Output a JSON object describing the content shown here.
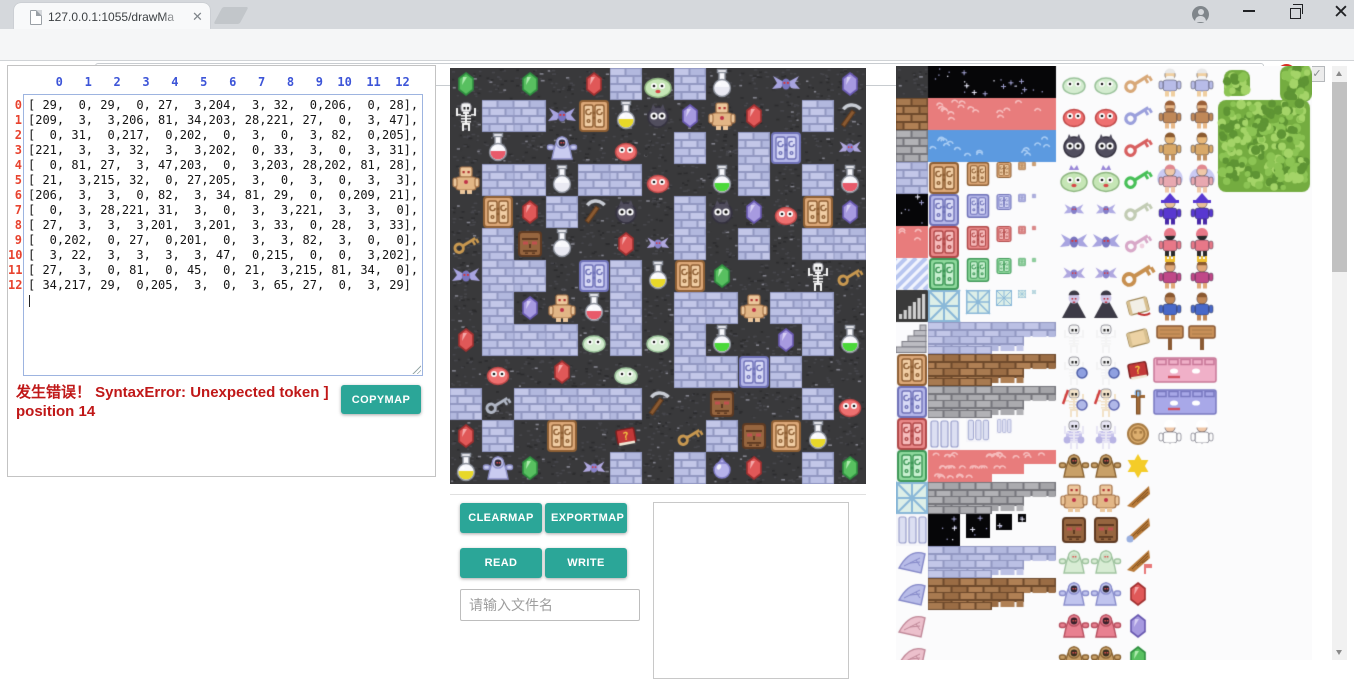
{
  "browser": {
    "tab_title": "127.0.0.1:1055/drawMa",
    "url_host": "127.0.0.1:1055",
    "url_path": "/drawMapGUI.html"
  },
  "editor": {
    "column_headers": [
      0,
      1,
      2,
      3,
      4,
      5,
      6,
      7,
      8,
      9,
      10,
      11,
      12
    ],
    "row_labels": [
      0,
      1,
      2,
      3,
      4,
      5,
      6,
      7,
      8,
      9,
      10,
      11,
      12
    ],
    "matrix": [
      [
        29,
        0,
        29,
        0,
        27,
        3,
        204,
        3,
        32,
        0,
        206,
        0,
        28
      ],
      [
        209,
        3,
        3,
        206,
        81,
        34,
        203,
        28,
        221,
        27,
        0,
        3,
        47
      ],
      [
        0,
        31,
        0,
        217,
        0,
        202,
        0,
        3,
        0,
        3,
        82,
        0,
        205
      ],
      [
        221,
        3,
        3,
        32,
        3,
        3,
        202,
        0,
        33,
        3,
        0,
        3,
        31
      ],
      [
        0,
        81,
        27,
        3,
        47,
        203,
        0,
        3,
        203,
        28,
        202,
        81,
        28
      ],
      [
        21,
        3,
        215,
        32,
        0,
        27,
        205,
        3,
        0,
        3,
        0,
        3,
        3
      ],
      [
        206,
        3,
        3,
        0,
        82,
        3,
        34,
        81,
        29,
        0,
        0,
        209,
        21
      ],
      [
        0,
        3,
        28,
        221,
        31,
        3,
        0,
        3,
        3,
        221,
        3,
        3,
        0
      ],
      [
        27,
        3,
        3,
        3,
        201,
        3,
        201,
        3,
        33,
        0,
        28,
        3,
        33
      ],
      [
        0,
        202,
        0,
        27,
        0,
        201,
        0,
        3,
        3,
        82,
        3,
        0,
        0
      ],
      [
        3,
        22,
        3,
        3,
        3,
        3,
        47,
        0,
        215,
        0,
        0,
        3,
        202
      ],
      [
        27,
        3,
        0,
        81,
        0,
        45,
        0,
        21,
        3,
        215,
        81,
        34,
        0
      ],
      [
        34,
        217,
        29,
        0,
        205,
        3,
        0,
        3,
        65,
        27,
        0,
        3,
        29
      ]
    ],
    "error_text": "发生错误！ SyntaxError: Unexpected token ] position 14",
    "copymap_label": "COPYMAP"
  },
  "controls": {
    "clearmap_label": "CLEARMAP",
    "exportmap_label": "EXPORTMAP",
    "read_label": "READ",
    "write_label": "WRITE",
    "filename_placeholder": "请输入文件名"
  },
  "map_legend": {
    "0": "floor-dark",
    "3": "wall-brick",
    "21": "key-gold",
    "22": "key-silver",
    "27": "gem-red",
    "28": "gem-purple",
    "29": "gem-green",
    "31": "flask-red",
    "32": "flask-white",
    "33": "flask-green",
    "34": "flask-yellow",
    "45": "book-red",
    "47": "pickaxe",
    "65": "orb-purple",
    "81": "gate-brown",
    "82": "gate-purple",
    "201": "slime-pale",
    "202": "slime-red",
    "203": "slime-dark",
    "204": "slime-green",
    "205": "bat-red",
    "206": "bat-purple",
    "209": "skeleton",
    "215": "stone-face",
    "217": "ghost-hooded",
    "221": "golem"
  },
  "tileset": {
    "left_column": [
      "dark-cobble",
      "brown-brick",
      "grey-stone",
      "blue-cobble",
      "starry",
      "red-terrain",
      "diag-stripes",
      "grad-bars",
      "stairs",
      "gate-brown",
      "gate-blue",
      "gate-red",
      "gate-green",
      "lattice",
      "pillar",
      "wing-blue",
      "wing-blue",
      "wing-pink",
      "wing-pink"
    ],
    "wide_strips": [
      "starry",
      "red-terrain",
      "blue-water"
    ],
    "gate_mip_rows": [
      "gate-brown",
      "gate-blue",
      "gate-red",
      "gate-green",
      "lattice"
    ],
    "step_rows": [
      "blue-cobble",
      "brown-brick",
      "grey-stone",
      "pillar",
      "red-terrain",
      "grey-stone",
      "starry",
      "blue-cobble",
      "brown-brick"
    ],
    "sprite_rows": [
      {
        "monster": "slime-pale",
        "item": "key-brown",
        "character": "elder"
      },
      {
        "monster": "slime-red",
        "item": "key-blue",
        "character": "dwarf"
      },
      {
        "monster": "slime-dark",
        "item": "key-red",
        "character": "fighter"
      },
      {
        "monster": "slime-green-crown",
        "item": "key-green",
        "character": "fairy"
      },
      {
        "monster": "bat-small",
        "item": "key-pale",
        "character": "wizard"
      },
      {
        "monster": "bat-purple",
        "item": "key-ornate",
        "character": "priest-red"
      },
      {
        "monster": "bat-red",
        "item": "key-large",
        "character": "monkey-king"
      },
      {
        "monster": "vampire",
        "item": "scroll-red",
        "character": "monkey"
      },
      {
        "monster": "skeleton",
        "item": "scroll",
        "character": "sign"
      },
      {
        "monster": "skeleton-shield",
        "item": "book-red",
        "character": "wall-face-pink"
      },
      {
        "monster": "skeleton-sword",
        "item": "staff",
        "character": "wall-face-blue"
      },
      {
        "monster": "skeleton-armor",
        "item": "coin",
        "character": "bride"
      },
      {
        "monster": "monkey-hood",
        "item": "star",
        "character": null
      },
      {
        "monster": "golem",
        "item": "wing",
        "character": null
      },
      {
        "monster": "stone-face",
        "item": "wing-ball",
        "character": null
      },
      {
        "monster": "ghost-pale",
        "item": "wing-flag",
        "character": null
      },
      {
        "monster": "ghost-blue",
        "item": "gem-red",
        "character": null
      },
      {
        "monster": "ghost-red",
        "item": "gem-purple",
        "character": null
      },
      {
        "monster": "ghost-brown",
        "item": "gem-green",
        "character": null
      }
    ],
    "trees": [
      "bush-diamond",
      "bush-square",
      "tree-large"
    ]
  },
  "colors": {
    "accent_teal": "#2ba698",
    "error_red": "#c01818",
    "header_blue": "#3d55d8",
    "row_label_red": "#e8432f"
  }
}
